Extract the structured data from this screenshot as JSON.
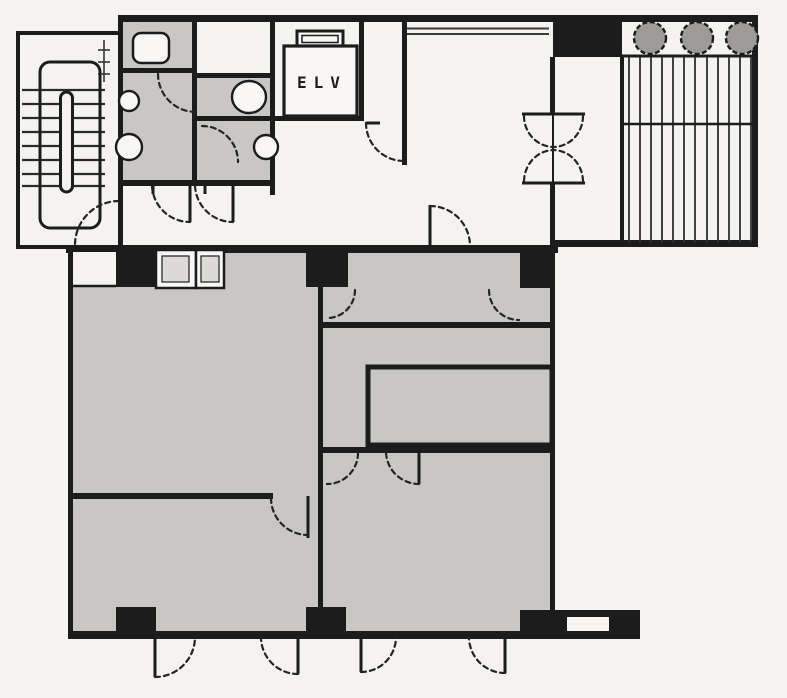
{
  "plan": {
    "labels": {
      "elevator": "ELV"
    },
    "colors": {
      "paper": "#f5f3ef",
      "wall": "#1c1c1c",
      "room_fill": "#c9c7c3",
      "fixture_fill": "#f8f7f5",
      "planter_fill": "#9c9b97",
      "window_inset": "#dcdad6"
    },
    "symbols": {
      "staircase": "staircase-icon",
      "elevator": "elevator-shaft-icon",
      "door_swing": "door-swing-icon",
      "double_door": "double-swing-door-icon",
      "toilet": "toilet-fixture-icon",
      "planter": "planter-icon",
      "louver": "louver-grille-icon"
    }
  }
}
